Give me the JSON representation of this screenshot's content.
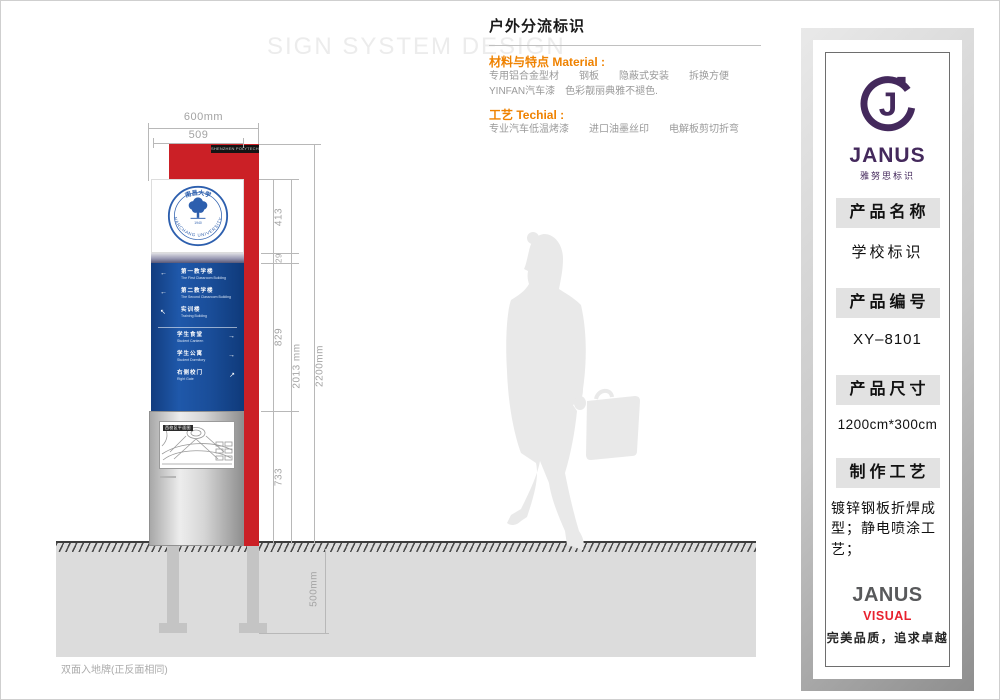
{
  "page": {
    "watermark": "SIGN SYSTEM DESIGN",
    "footer_note": "双面入地牌(正反面相同)"
  },
  "header": {
    "title": "户外分流标识",
    "material_label": "材料与特点 Material :",
    "material_line1": "专用铝合金型材　　钢板　　隐蔽式安装　　拆换方便",
    "material_line2": "YINFAN汽车漆　色彩靓丽典雅不褪色.",
    "technique_label": "工艺 Techial :",
    "technique_line1": "专业汽车低温烤漆　　进口油墨丝印　　电解板剪切折弯"
  },
  "sign": {
    "header_strip": "SHENZHEN POLYTECHNIC",
    "seal_top": "南昌大学",
    "seal_arc": "NANCHANG UNIVERSITY",
    "seal_year": "1940",
    "map_title": "西校区平面图",
    "directory_up": [
      {
        "cn": "第一教学楼",
        "en": "The First Classroom Building",
        "arrow": "←"
      },
      {
        "cn": "第二教学楼",
        "en": "The Second Classroom Building",
        "arrow": "←"
      },
      {
        "cn": "实训楼",
        "en": "Training Building",
        "arrow": "↖"
      }
    ],
    "directory_down": [
      {
        "cn": "学生食堂",
        "en": "Student Canteen",
        "arrow": "→"
      },
      {
        "cn": "学生公寓",
        "en": "Student Dormitory",
        "arrow": "→"
      },
      {
        "cn": "右侧校门",
        "en": "Right Gate",
        "arrow": "↗"
      }
    ]
  },
  "dims": {
    "top_width": "600mm",
    "panel_width": "509",
    "seg_logo": "413",
    "seg_strip": "29",
    "seg_blue": "829",
    "seg_base": "733",
    "inner_height": "2013 mm",
    "outer_height": "2200mm",
    "foundation_depth": "500mm"
  },
  "panel": {
    "brand": "JANUS",
    "brand_cn": "雅努思标识",
    "sections": [
      {
        "label": "产品名称",
        "value": "学校标识"
      },
      {
        "label": "产品编号",
        "value": "XY–8101"
      },
      {
        "label": "产品尺寸",
        "value": "1200cm*300cm"
      },
      {
        "label": "制作工艺",
        "value": "镀锌钢板折焊成型；静电喷涂工艺；"
      }
    ],
    "footer_brand": "JANUS",
    "footer_brand_accent": "VISUAL",
    "slogan": "完美品质，追求卓越"
  },
  "colors": {
    "sign_red": "#cb2026",
    "sign_blue": "#1a4e9a",
    "brand_purple": "#44295c",
    "accent_orange": "#ef8200",
    "accent_red": "#e8212e"
  }
}
